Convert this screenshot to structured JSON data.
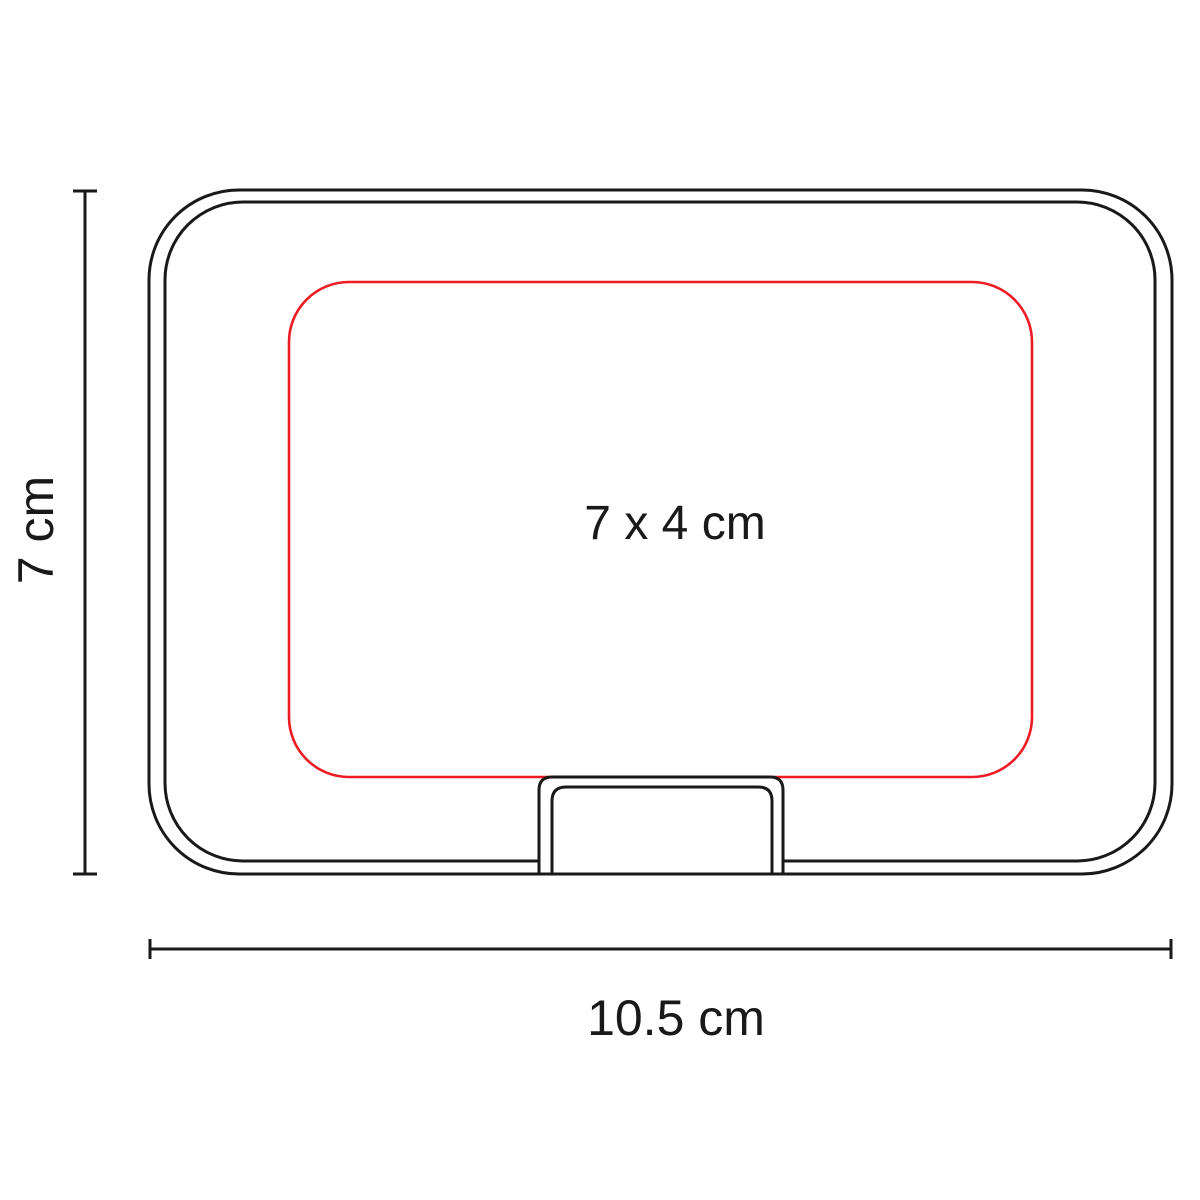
{
  "labels": {
    "height": "7 cm",
    "width": "10.5 cm",
    "imprint_area": "7 x 4 cm"
  },
  "colors": {
    "outline": "#191919",
    "imprint_area": "#ed1c24",
    "background": "#ffffff"
  }
}
